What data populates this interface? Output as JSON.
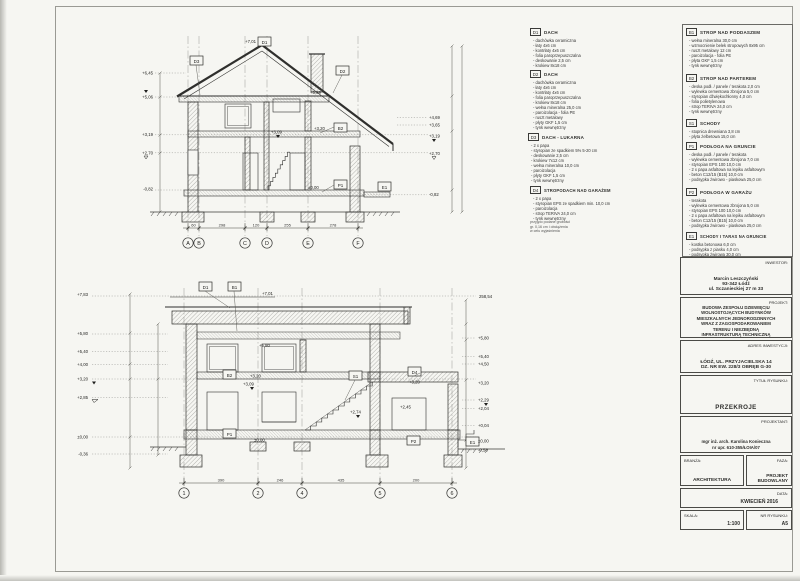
{
  "sheet": {
    "bg": "#f6f6f2",
    "ink": "#2f2f2d"
  },
  "top_drawing": {
    "grid": [
      "A",
      "B",
      "C",
      "D",
      "E",
      "F"
    ],
    "dims": [
      "60",
      "298",
      "120",
      "255",
      "278"
    ],
    "ridge_level": "+7,01",
    "left_levels": [
      "+6,45",
      "+5,06",
      "+3,19",
      "+2,70",
      "-0,82"
    ],
    "right_levels": [
      "+4,69",
      "+3,65",
      "+3,19",
      "+2,70",
      "-0,82"
    ],
    "tags": {
      "d1": "D1",
      "d2": "D2",
      "d3": "D3",
      "b2": "B2",
      "p1": "P1",
      "e1": "E1"
    },
    "levels": {
      "l589": "+5,89",
      "l320": "+3,20",
      "l309": "+3,09",
      "l000": "±0,00"
    }
  },
  "bottom_drawing": {
    "grid": [
      "1",
      "2",
      "4",
      "5",
      "6"
    ],
    "dims": [
      "390",
      "246",
      "435",
      "200"
    ],
    "top_level": "+7,01",
    "datum_level": "258,54",
    "left_levels": [
      "+7,83",
      "+5,80",
      "+5,40",
      "+4,00",
      "+3,20",
      "+2,85",
      "±0,00",
      "-0,36"
    ],
    "right_levels": [
      "+5,80",
      "+5,40",
      "+4,50",
      "+3,20",
      "+2,29",
      "+2,04",
      "+0,04",
      "±0,00",
      "-0,58"
    ],
    "tags": {
      "d1": "D1",
      "b1": "B1",
      "b2": "B2",
      "s1": "S1",
      "d4": "D4",
      "p1": "P1",
      "p2": "P2",
      "e1": "E1"
    },
    "levels": {
      "l580": "+5,80",
      "l320": "+3,20",
      "l309": "+3,09",
      "l274": "+2,74",
      "l245": "+2,45",
      "l000": "±0,00",
      "l320g": "+3,20"
    }
  },
  "legend_d": [
    {
      "code": "D1",
      "title": "DACH",
      "items": [
        "dachówka ceramiczna",
        "łaty 4x6 cm",
        "kontrłaty 4x6 cm",
        "folia paroprzepuszczalna",
        "deskowanie 2,5 cm",
        "krokiew 8x18 cm"
      ]
    },
    {
      "code": "D2",
      "title": "DACH",
      "items": [
        "dachówka ceramiczna",
        "łaty 4x6 cm",
        "kontrłaty 4x6 cm",
        "folia paroprzepuszczalna",
        "krokiew 8x18 cm",
        "wełna mineralna 25,0 cm",
        "paroizolacja - folia PE",
        "ruszt metalowy",
        "płyty GKF 1,5 cm",
        "tynk wewnętrzny"
      ]
    },
    {
      "code": "D3",
      "title": "DACH - LUKARNA",
      "items": [
        "2 x papa",
        "styropian ze spadkiem 5% 5-20 cm",
        "deskowanie 2,5 cm",
        "krokiew 7x12 cm",
        "wełna mineralna 10,0 cm",
        "paroizolacja",
        "płyty GKF 1,5 cm",
        "tynk wewnętrzny"
      ]
    },
    {
      "code": "D4",
      "title": "STROPODACH NAD GARAŻEM",
      "items": [
        "2 x papa",
        "styropian EPS ze spadkiem min. 10,0 cm",
        "paroizolacja",
        "strop TERIVA 24,0 cm",
        "tynk wewnętrzny"
      ]
    }
  ],
  "legend_note": [
    "przyjęto podane grubości",
    "gr. 0,16 cm i obciążenia",
    "w celu wyjaśnienia"
  ],
  "legend_b": [
    {
      "code": "B1",
      "title": "STROP NAD PODDASZEM",
      "items": [
        "wełna mineralna 30,0 cm",
        "wzmocnienie belek stropowych 8x95 cm",
        "ruszt metalowy 12 cm",
        "paroizolacja - folia PE",
        "płyta GKF 1,5 cm",
        "tynk wewnętrzny"
      ]
    },
    {
      "code": "B2",
      "title": "STROP NAD PARTEREM",
      "items": [
        "deska podł. / panele / terakota 2,0 cm",
        "wylewka cementowa zbrojona 5,0 cm",
        "styropian dźwiękochłonny 4,0 cm",
        "folia polietylenowa",
        "strop TERIVA 24,0 cm",
        "tynk wewnętrzny"
      ]
    },
    {
      "code": "S1",
      "title": "SCHODY",
      "items": [
        "stopnica drewniana 3,8 cm",
        "płyta żelbetowa 15,0 cm"
      ]
    },
    {
      "code": "P1",
      "title": "PODŁOGA NA GRUNCIE",
      "items": [
        "deska podł. / panele / terakota",
        "wylewka cementowa zbrojona 7,0 cm",
        "styropian EPS 100 10,0 cm",
        "2 x papa asfaltowa na lepiku asfaltowym",
        "beton C12/15 (B15) 10,0 cm",
        "podsypka żwirowo - piaskowa 25,0 cm"
      ]
    },
    {
      "code": "P2",
      "title": "PODŁOGA W GARAŻU",
      "items": [
        "terakota",
        "wylewka cementowa zbrojona 5,0 cm",
        "styropian EPS 100 10,0 cm",
        "2 x papa asfaltowa na lepiku asfaltowym",
        "beton C12/15 (B15) 10,0 cm",
        "podsypka żwirowo - piaskowa 25,0 cm"
      ]
    },
    {
      "code": "E1",
      "title": "SCHODY I TARAS NA GRUNCIE",
      "items": [
        "kostka betonowa 6,0 cm",
        "podsypka z piasku 4,0 cm",
        "podsypka żwirowa 30,0 cm"
      ]
    }
  ],
  "titleblock": {
    "inwestor_label": "INWESTOR:",
    "inwestor_lines": [
      "Marcin Leszczyński",
      "93-342 Łódź",
      "ul. Sczanieckiej 27 m 33"
    ],
    "projekt_label": "PROJEKT:",
    "projekt_lines": [
      "BUDOWA ZESPOŁU DZIEWIĘCIU",
      "WOLNOSTOJĄCYCH BUDYNKÓW",
      "MIESZKALNYCH JEDNORODZINNYCH",
      "WRAZ Z ZAGOSPODAROWANIEM",
      "TERENU I NIEZBĘDNĄ",
      "INFRASTRUKTURĄ TECHNICZNĄ"
    ],
    "adres_label": "ADRES INWESTYCJI:",
    "adres_lines": [
      "ŁÓDŹ, UL. PRZYJACIELSKA 14",
      "DZ. NR EW. 228/3 OBRĘB G-30"
    ],
    "tytul_label": "TYTUŁ RYSUNKU:",
    "tytul": "PRZEKROJE",
    "projektant_label": "PROJEKTANT:",
    "projektant_lines": [
      "mgr inż. arch. Karolina Konieczna",
      "nr upr. 610-355/ŁOIA/07"
    ],
    "branza_label": "BRANŻA:",
    "branza": "ARCHITEKTURA",
    "faza_label": "FAZA:",
    "faza_lines": [
      "PROJEKT",
      "BUDOWLANY"
    ],
    "data_label": "DATA:",
    "data": "KWIECIEŃ 2016",
    "skala_label": "SKALA:",
    "skala": "1:100",
    "nr_label": "NR RYSUNKU:",
    "nr": "A5"
  }
}
